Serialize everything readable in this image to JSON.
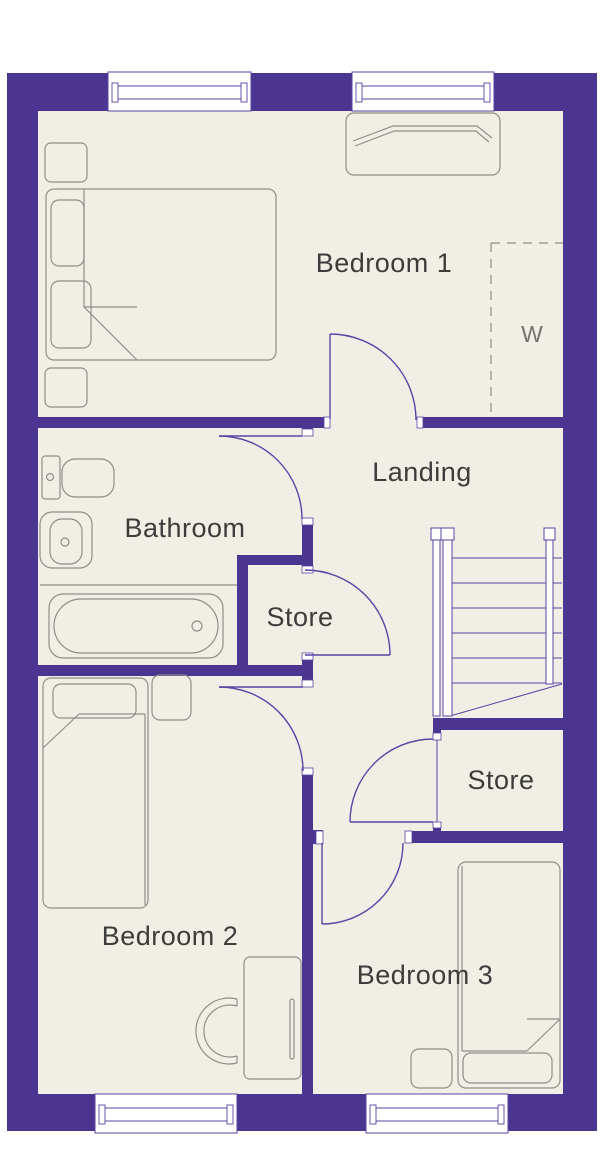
{
  "rooms": {
    "bedroom1": {
      "label": "Bedroom 1"
    },
    "landing": {
      "label": "Landing"
    },
    "bathroom": {
      "label": "Bathroom"
    },
    "store_middle": {
      "label": "Store"
    },
    "store_lower": {
      "label": "Store"
    },
    "bedroom2": {
      "label": "Bedroom 2"
    },
    "bedroom3": {
      "label": "Bedroom 3"
    },
    "wardrobe": {
      "label": "W"
    }
  },
  "colors": {
    "wall": "#4a3590",
    "floor": "#f1efe5",
    "furniture_line": "#8f8e88",
    "door_line": "#5b43a4",
    "text": "#3c3c3a",
    "wardrobe_label": "#72726f"
  }
}
